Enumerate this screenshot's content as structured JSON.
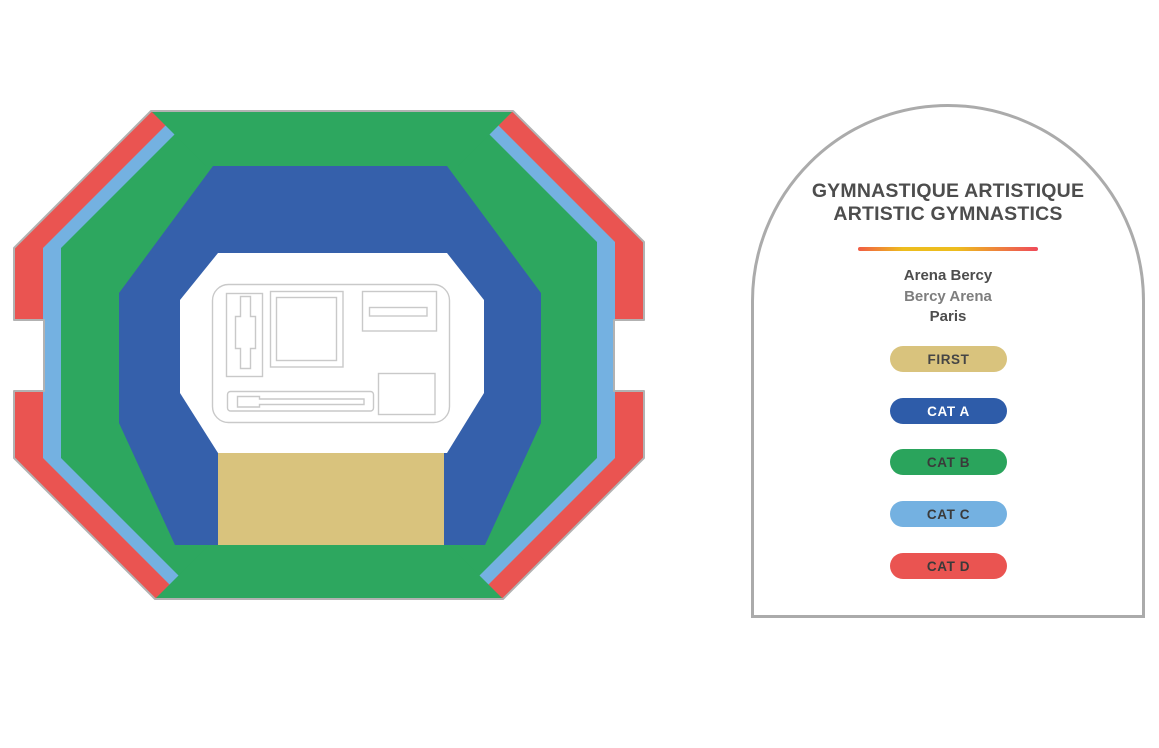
{
  "map": {
    "floor_color": "#FFFFFF",
    "outline_color": "#B2B2B2",
    "floorplan_outline_color": "#C9C9C9",
    "sections": {
      "first": {
        "label": "FIRST",
        "color": "#D9C37D"
      },
      "cat_a": {
        "label": "CAT A",
        "color": "#3560AB"
      },
      "cat_b": {
        "label": "CAT B",
        "color": "#2DA75F"
      },
      "cat_c": {
        "label": "CAT C",
        "color": "#74B1E1"
      },
      "cat_d": {
        "label": "CAT D",
        "color": "#EA5451"
      }
    }
  },
  "panel": {
    "title_line1": "GYMNASTIQUE ARTISTIQUE",
    "title_line2": "ARTISTIC GYMNASTICS",
    "venue_line1": "Arena Bercy",
    "venue_line2": "Bercy Arena",
    "venue_line3": "Paris",
    "divider_gradient": [
      "#F15C44",
      "#EDBD1E",
      "#EF4A5A"
    ],
    "border_color": "#ABABAB",
    "legend": [
      {
        "id": "first",
        "label": "FIRST",
        "bg": "#D9C37D",
        "fg": "#454545"
      },
      {
        "id": "cat-a",
        "label": "CAT A",
        "bg": "#2E5CA9",
        "fg": "#FFFFFF"
      },
      {
        "id": "cat-b",
        "label": "CAT B",
        "bg": "#2AA45C",
        "fg": "#3A3A3A"
      },
      {
        "id": "cat-c",
        "label": "CAT C",
        "bg": "#74B1E1",
        "fg": "#3A3A3A"
      },
      {
        "id": "cat-d",
        "label": "CAT D",
        "bg": "#EA5451",
        "fg": "#3A3A3A"
      }
    ]
  }
}
